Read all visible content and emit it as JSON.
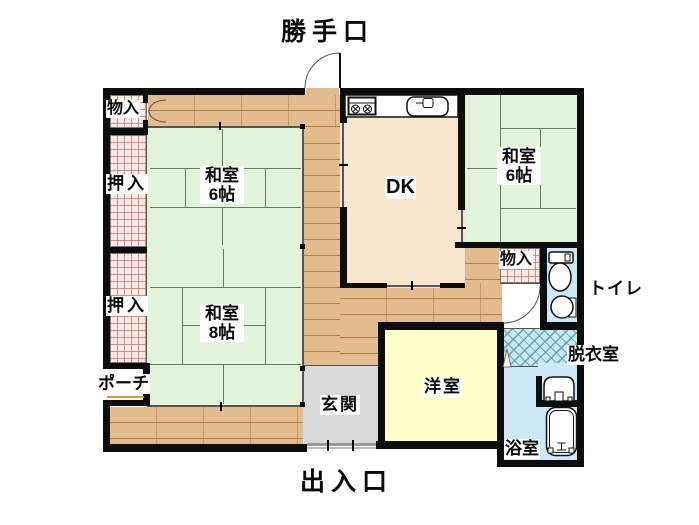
{
  "plan": {
    "exterior_labels": {
      "back_door": "勝手口",
      "main_entrance": "出入口"
    },
    "rooms": {
      "dk": {
        "label": "DK"
      },
      "washitsu_left_6": {
        "name_line": "和室",
        "size_line": "6帖"
      },
      "washitsu_8": {
        "name_line": "和室",
        "size_line": "8帖"
      },
      "washitsu_right_6": {
        "name_line": "和室",
        "size_line": "6帖"
      },
      "youshitsu": {
        "label": "洋室"
      },
      "genkan": {
        "label": "玄関"
      },
      "toilet": {
        "label": "トイレ"
      },
      "dressing_room": {
        "label": "脱衣室"
      },
      "bathroom": {
        "label": "浴室"
      },
      "porch": {
        "label": "ポーチ"
      },
      "storage_top_left": {
        "label": "物入"
      },
      "storage_right": {
        "label": "物入"
      },
      "closet_upper": {
        "label": "押入"
      },
      "closet_lower": {
        "label": "押入"
      }
    },
    "fixtures": [
      "kitchen-stove",
      "kitchen-sink",
      "toilet-bowl",
      "hand-basin",
      "wash-basin",
      "bathtub"
    ],
    "colors": {
      "tatami": "#e3f3dc",
      "wood_floor": "#e2bc8e",
      "dk_floor": "#fae6d0",
      "western_room": "#ffffc9",
      "entrance_gray": "#d9d9d9",
      "wet_area_blue": "#cfe8f7",
      "closet_hatch": "#faeceb",
      "wall": "#0d0d0d"
    }
  }
}
